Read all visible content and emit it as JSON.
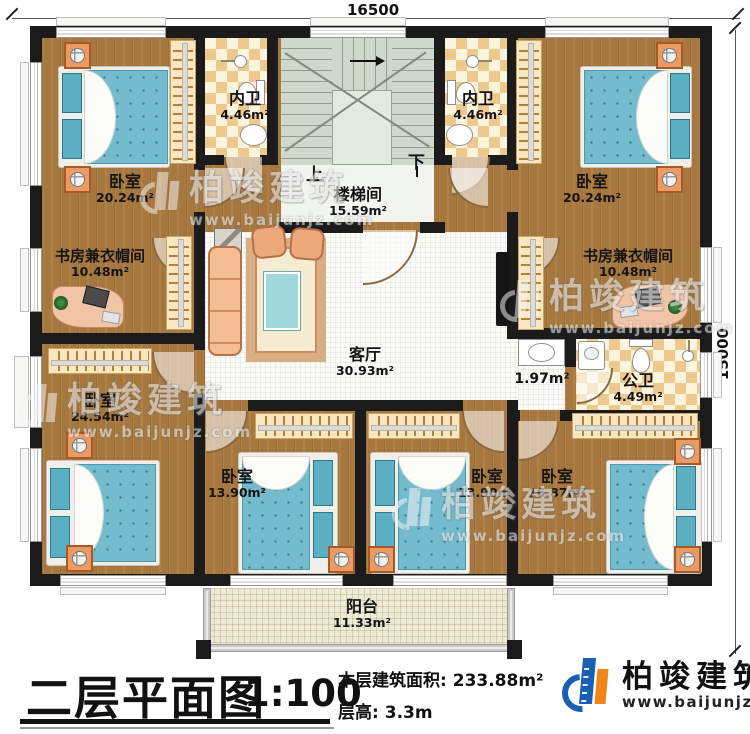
{
  "dimensions": {
    "top": "16500",
    "right": "15000"
  },
  "stairwell": {
    "label": "楼梯间",
    "area": "15.59m²",
    "up": "上",
    "down": "下"
  },
  "rooms": {
    "bedroom_tl": {
      "label": "卧室",
      "area": "20.24m²"
    },
    "bath_left": {
      "label": "内卫",
      "area": "4.46m²"
    },
    "bath_right": {
      "label": "内卫",
      "area": "4.46m²"
    },
    "bedroom_tr": {
      "label": "卧室",
      "area": "20.24m²"
    },
    "study_left": {
      "label": "书房兼衣帽间",
      "area": "10.48m²"
    },
    "study_right": {
      "label": "书房兼衣帽间",
      "area": "10.48m²"
    },
    "living": {
      "label": "客厅",
      "area": "30.93m²"
    },
    "hall": {
      "area": "1.97m²"
    },
    "bath_public": {
      "label": "公卫",
      "area": "4.49m²"
    },
    "bedroom_left": {
      "label": "卧室",
      "area": "24.54m²"
    },
    "bedroom_b1": {
      "label": "卧室",
      "area": "13.90m²"
    },
    "bedroom_b2": {
      "label": "卧室",
      "area": "13.90m²"
    },
    "bedroom_br": {
      "label": "卧室",
      "area": "16.87m²"
    },
    "balcony": {
      "label": "阳台",
      "area": "11.33m²"
    }
  },
  "footer": {
    "title": "二层平面图",
    "scale": "1:100",
    "area_label": "本层建筑面积:",
    "area_value": "233.88m²",
    "height_label": "层高:",
    "height_value": "3.3m"
  },
  "brand": {
    "name": "柏竣建筑",
    "website": "www.baijunjz.com",
    "blue": "#1a5fb4",
    "orange": "#f08519"
  },
  "watermark": {
    "name": "柏竣建筑",
    "website": "www.baijunjz.com"
  }
}
